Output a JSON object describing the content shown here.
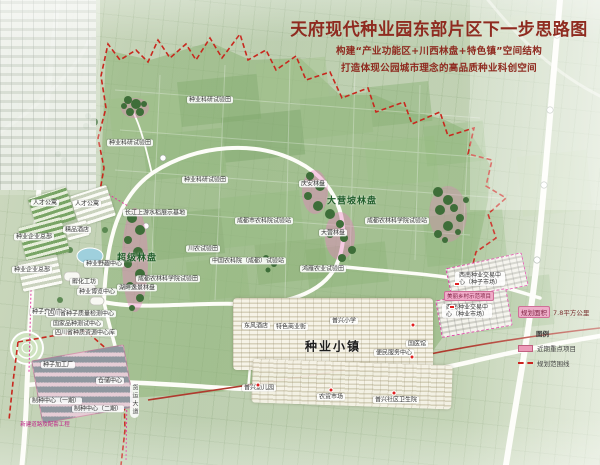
{
  "header": {
    "title": "天府现代种业园东部片区下一步思路图",
    "subtitle1": "构建“产业功能区+川西林盘+特色镇”空间结构",
    "subtitle2": "打造体现公园城市理念的高品质种业科创空间"
  },
  "legend": {
    "area_label": "规划面积",
    "area_value": "7.8平方公里",
    "title": "图例",
    "items": [
      {
        "label": "近期重点项目",
        "swatch_color": "#ec9cb9"
      },
      {
        "label": "规划范围线",
        "swatch_color": "#cc2420"
      }
    ]
  },
  "map": {
    "labels": [
      {
        "t": "种业科研试验田"
      },
      {
        "t": "种业科研试验田"
      },
      {
        "t": "种业科研试验田"
      },
      {
        "t": "长江上游水稻展示基地"
      },
      {
        "t": "川农试验田"
      },
      {
        "t": "成都市农科院试验站"
      },
      {
        "t": "成都农林科学院试验站"
      },
      {
        "t": "成都农林科学院试验田"
      },
      {
        "t": "中国农科院（成都）试验站"
      },
      {
        "t": "鸿雁农业试验田"
      },
      {
        "t": "庆安林盘"
      },
      {
        "t": "大营林盘"
      },
      {
        "t": "湖畔逸景林盘"
      },
      {
        "t": "超级林盘"
      },
      {
        "t": "大营坡林盘"
      },
      {
        "t": "种业小镇"
      },
      {
        "t": "人才公寓"
      },
      {
        "t": "人才公寓"
      },
      {
        "t": "精品酒店"
      },
      {
        "t": "种业企业总部"
      },
      {
        "t": "种业企业总部"
      },
      {
        "t": "种业野趣中心"
      },
      {
        "t": "孵化工坊"
      },
      {
        "t": "种业博览中心"
      },
      {
        "t": "种子交易中心"
      },
      {
        "t": "四川省种子质量检测中心"
      },
      {
        "t": "国家品种测试中心"
      },
      {
        "t": "四川省种质资源中心库"
      },
      {
        "t": "种子加工厂"
      },
      {
        "t": "仓储中心"
      },
      {
        "t": "制种中心（一期）"
      },
      {
        "t": "制种中心（二期）"
      },
      {
        "t": "新建道路及配套工程"
      },
      {
        "t": "东风酒店"
      },
      {
        "t": "特色商业街"
      },
      {
        "t": "普兴小学"
      },
      {
        "t": "便民服务中心"
      },
      {
        "t": "国医馆"
      },
      {
        "t": "普兴幼儿园"
      },
      {
        "t": "农贸市场"
      },
      {
        "t": "普兴社区卫生院"
      },
      {
        "t": "西南种业交易中心（种子市场）"
      },
      {
        "t": "美丽乡村示范项目"
      },
      {
        "t": "西南种业交易中心（种业市场）"
      },
      {
        "t": "货运大道"
      }
    ],
    "boundary_color": "#c8281e",
    "key_project_color": "#e01f1f",
    "linpan_highlight_color": "#e87cc0"
  }
}
